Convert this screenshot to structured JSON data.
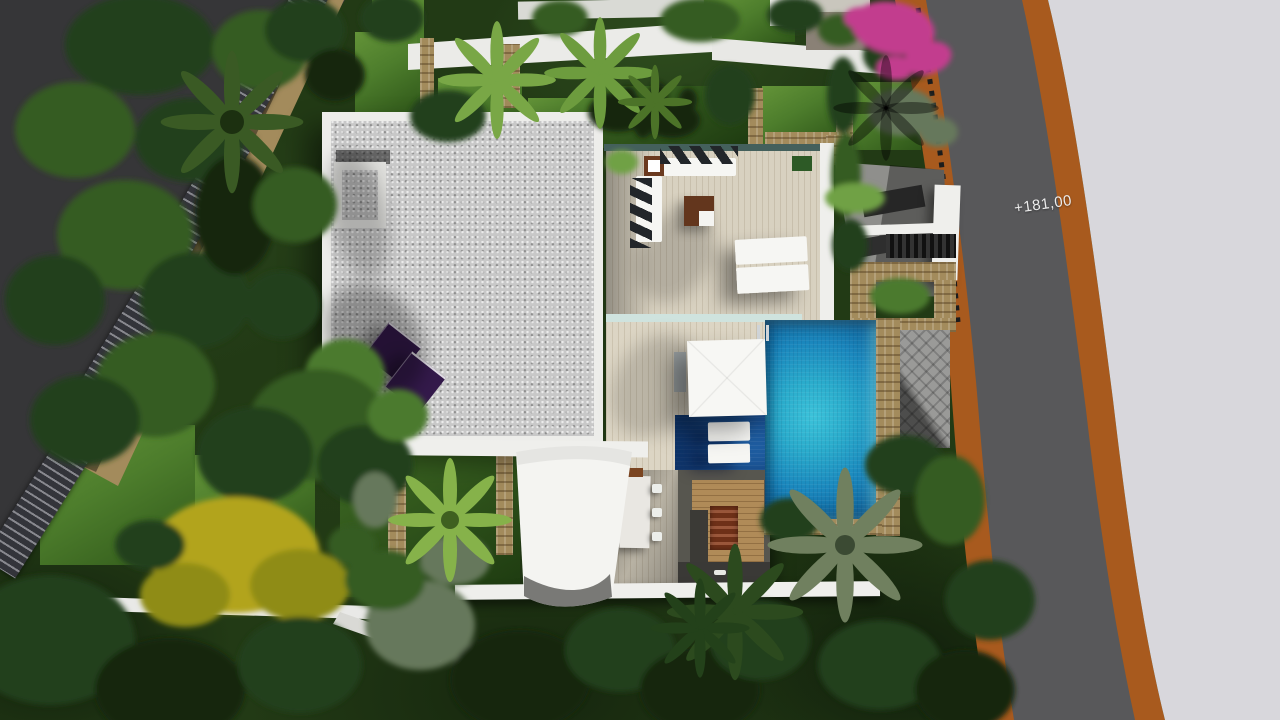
{
  "scene": {
    "description": "Aerial 3D architectural render of a modern villa: flat gravel roof with solar panels, wooden sun terrace with lounge furniture, swimming pool with shallow shelf, shade sail, outdoor kitchen and landscaped garden beside a curved road",
    "elevation_label": "+181,00"
  },
  "colors": {
    "asphalt": "#58585a",
    "asphalt_dark": "#2c2c2e",
    "road_edge": "#a85a1e",
    "sidewalk": "#d8d7dc",
    "roof_gravel": "#c8c8c8",
    "parapet": "#ededea",
    "white": "#efefec",
    "wood_deck": "#d8d1c0",
    "wood_warm": "#b08b58",
    "pool_bright": "#3cc3da",
    "pool_mid": "#1a87bd",
    "pool_deep": "#0d5a92",
    "pool_shelf": "#1f5fa3",
    "panel_purple": "#33194a",
    "lawn": "#4d7d2c",
    "foliage_dark": "#15250e",
    "foliage_mid": "#365c22",
    "foliage_light": "#6fa144",
    "bougainvillea": "#c23e8e",
    "yellow_tree": "#b2a41e",
    "stone_tan": "#a38b5c",
    "counter_dark": "#3b3a36",
    "stair_wood": "#7c3a25"
  }
}
